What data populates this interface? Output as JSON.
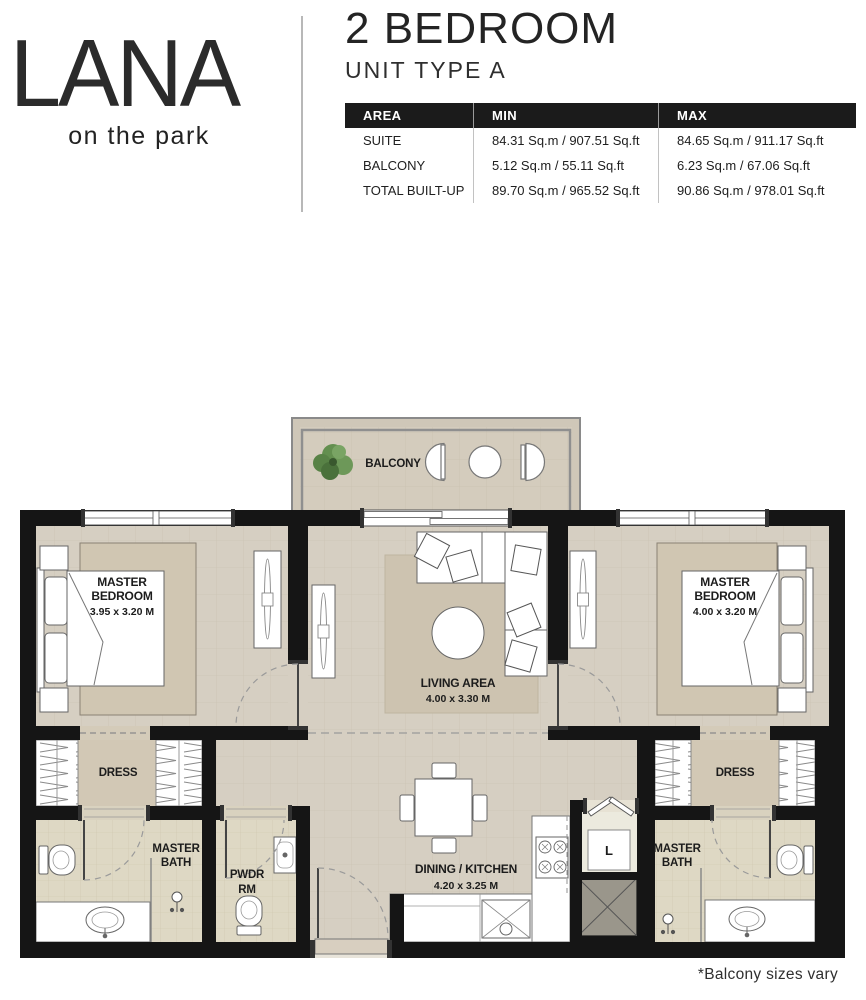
{
  "brand": {
    "logo": "LANA",
    "tagline": "on the park"
  },
  "header": {
    "title": "2 BEDROOM",
    "subtitle": "UNIT TYPE A"
  },
  "area_table": {
    "columns": [
      "AREA",
      "MIN",
      "MAX"
    ],
    "rows": [
      {
        "area": "SUITE",
        "min": "84.31 Sq.m / 907.51 Sq.ft",
        "max": "84.65 Sq.m / 911.17 Sq.ft"
      },
      {
        "area": "BALCONY",
        "min": "5.12 Sq.m / 55.11 Sq.ft",
        "max": "6.23 Sq.m / 67.06 Sq.ft"
      },
      {
        "area": "TOTAL BUILT-UP",
        "min": "89.70 Sq.m / 965.52 Sq.ft",
        "max": "90.86 Sq.m / 978.01 Sq.ft"
      }
    ]
  },
  "plan": {
    "balcony": "BALCONY",
    "bedroom_left": {
      "name_line1": "MASTER",
      "name_line2": "BEDROOM",
      "dims": "3.95 x 3.20 M"
    },
    "bedroom_right": {
      "name_line1": "MASTER",
      "name_line2": "BEDROOM",
      "dims": "4.00 x 3.20 M"
    },
    "living": {
      "name": "LIVING AREA",
      "dims": "4.00 x 3.30 M"
    },
    "dining": {
      "name": "DINING / KITCHEN",
      "dims": "4.20 x 3.25 M"
    },
    "dress_left": "DRESS",
    "dress_right": "DRESS",
    "bath_left": {
      "line1": "MASTER",
      "line2": "BATH"
    },
    "bath_right": {
      "line1": "MASTER",
      "line2": "BATH"
    },
    "pwdr": {
      "line1": "PWDR",
      "line2": "RM"
    },
    "laundry": "L"
  },
  "footnote": "*Balcony sizes vary",
  "palette": {
    "wall": "#151515",
    "floor": "#d6cfc2",
    "floor_dark": "#cdc3b0",
    "bath_tile": "#ded8c4",
    "shaft": "#9a968b",
    "plant_green": "#4e7c3c",
    "table_header_bg": "#1b1b1b"
  }
}
